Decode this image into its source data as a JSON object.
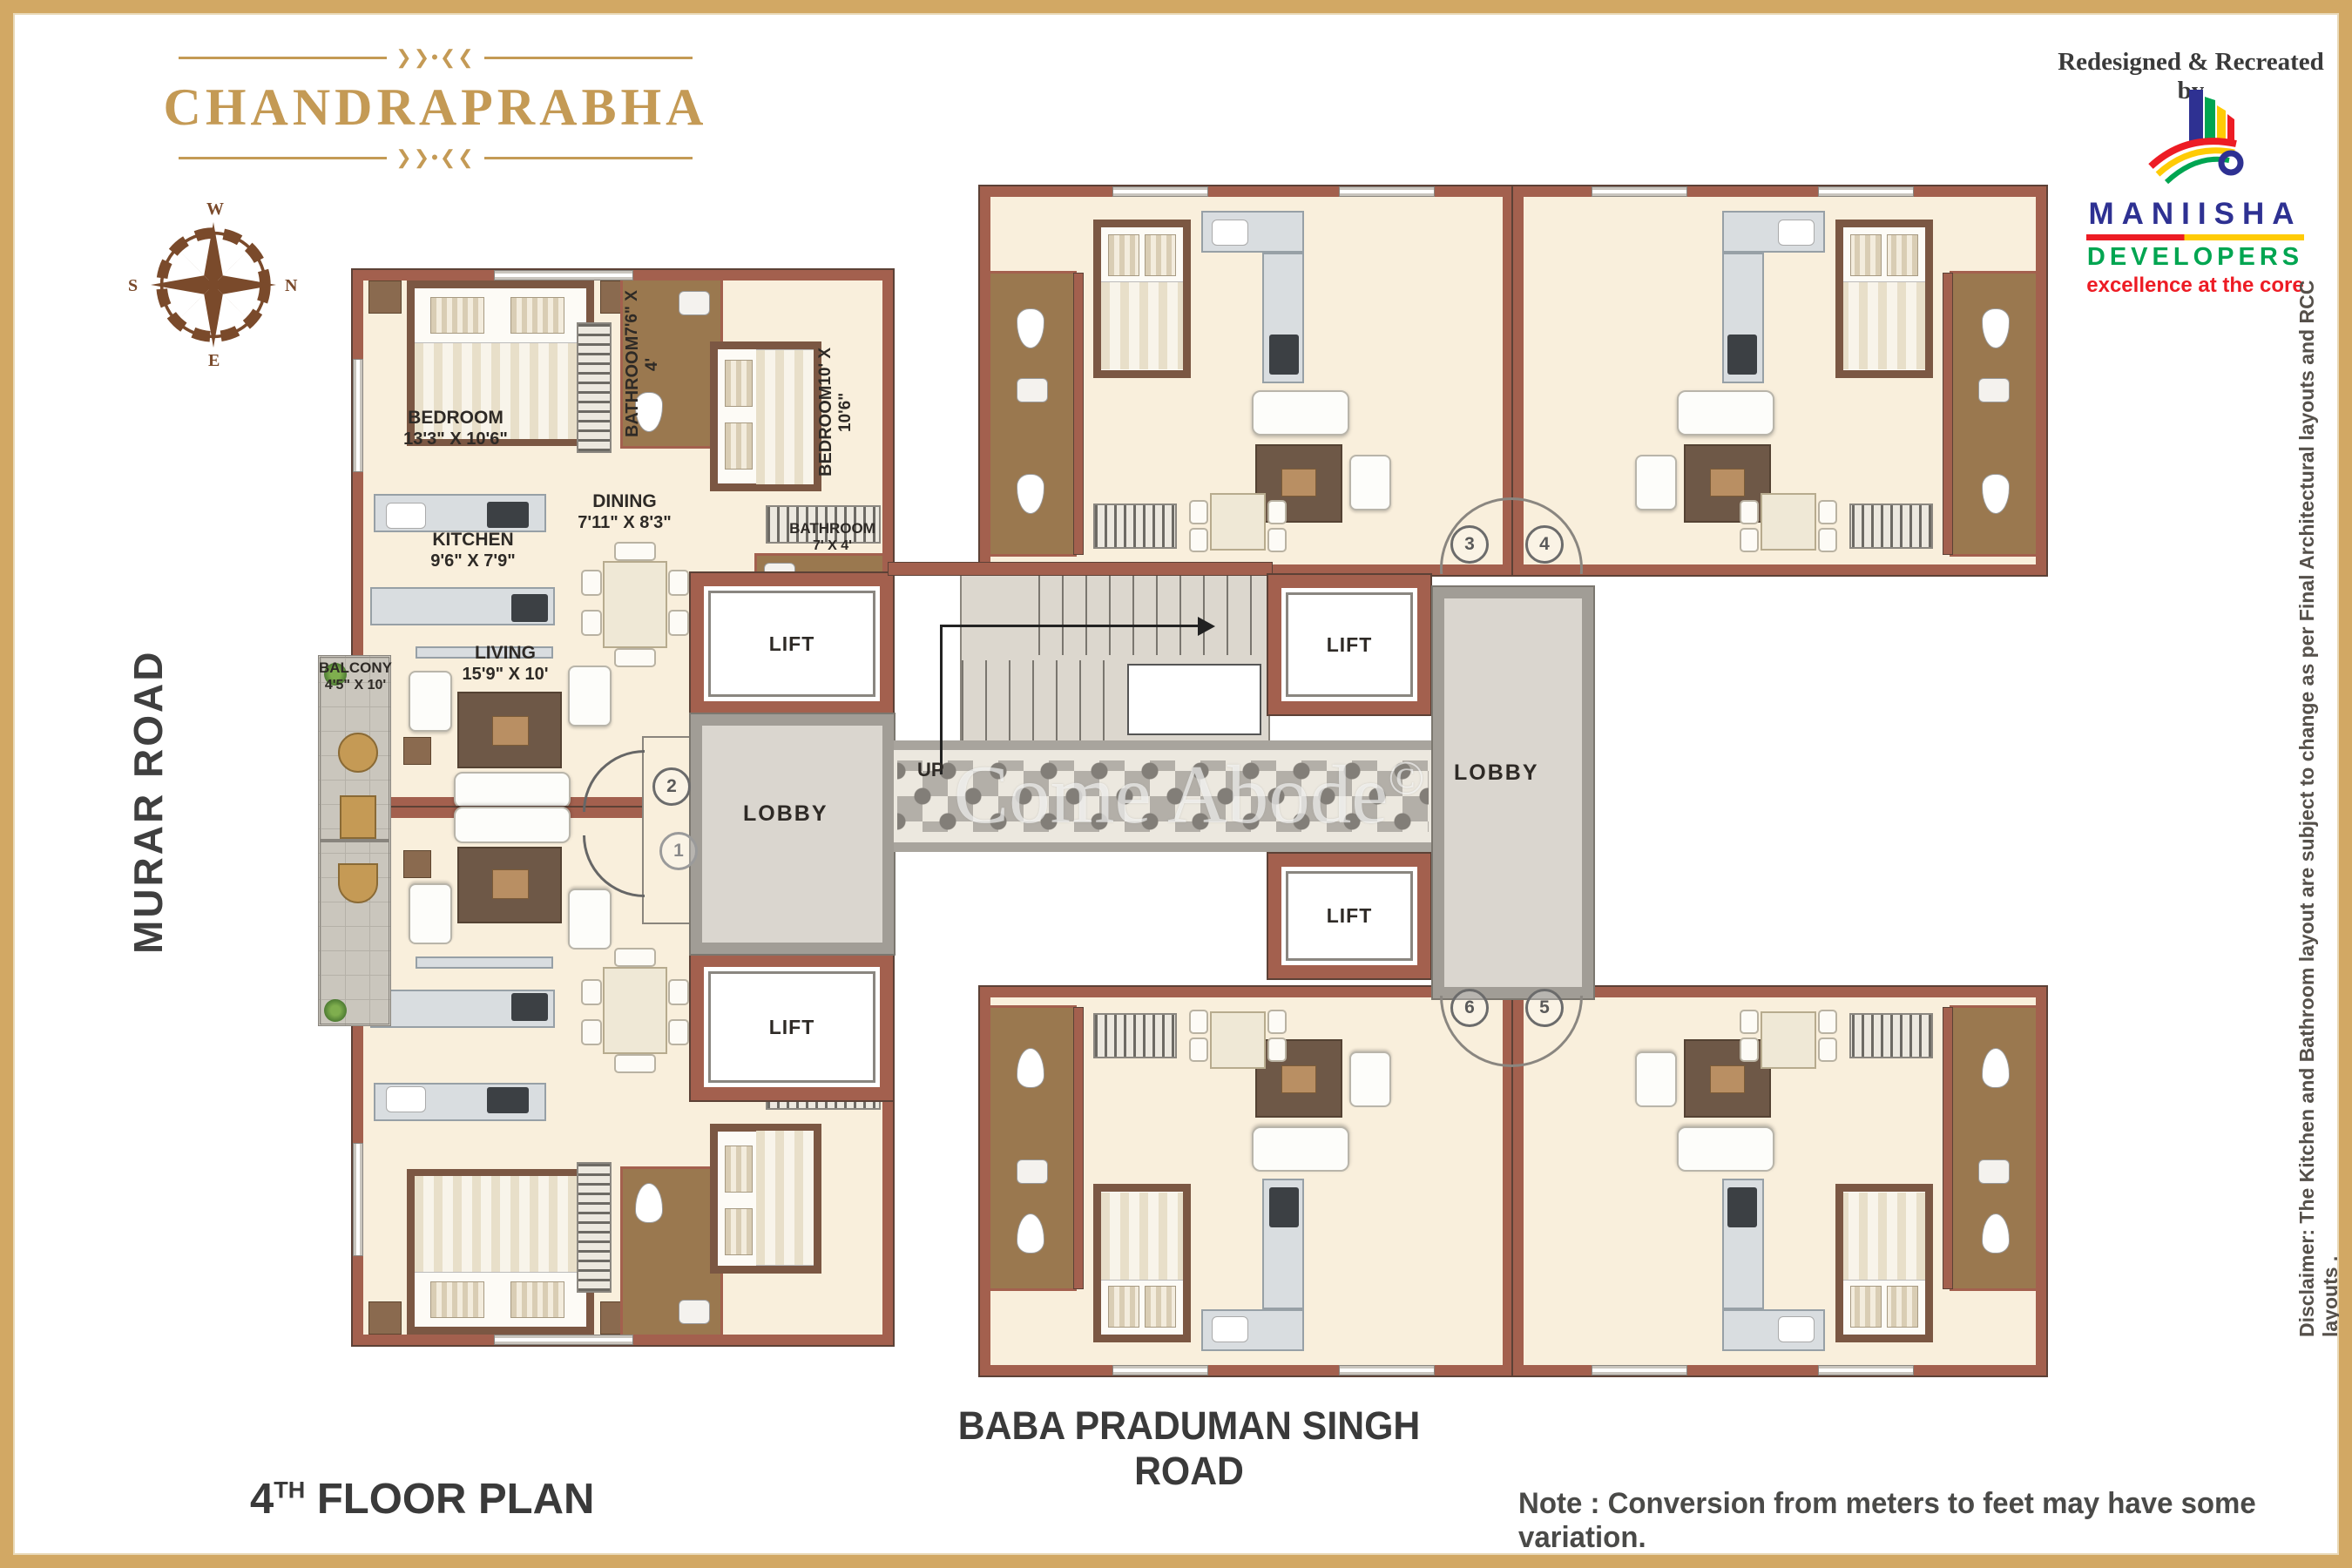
{
  "brand": {
    "title": "CHANDRAPRABHA",
    "ornament_glyph": "❯❯•❮❮",
    "credit": "Redesigned & Recreated by",
    "logo": {
      "name": "MANIISHA",
      "type": "DEVELOPERS",
      "tagline": "excellence at the core"
    }
  },
  "compass": {
    "n": "N",
    "s": "S",
    "e": "E",
    "w": "W"
  },
  "roads": {
    "left": "MURAR ROAD",
    "bottom": "BABA PRADUMAN SINGH ROAD"
  },
  "plan": {
    "rooms": {
      "bedroom1": {
        "name": "BEDROOM",
        "dims": "13'3\" X 10'6\""
      },
      "bathroom1": {
        "name": "BATHROOM",
        "dims": "7'6\" X 4'"
      },
      "bedroom2": {
        "name": "BEDROOM",
        "dims": "10' X 10'6\""
      },
      "dining": {
        "name": "DINING",
        "dims": "7'11\" X 8'3\""
      },
      "kitchen": {
        "name": "KITCHEN",
        "dims": "9'6\" X 7'9\""
      },
      "bathroom2": {
        "name": "BATHROOM",
        "dims": "7' X 4'"
      },
      "balcony": {
        "name": "BALCONY",
        "dims": "4'5\" X 10'"
      },
      "living": {
        "name": "LIVING",
        "dims": "15'9\" X 10'"
      }
    },
    "lift_label": "LIFT",
    "lobby_label": "LOBBY",
    "up_label": "UP",
    "units": {
      "u1": "1",
      "u2": "2",
      "u3": "3",
      "u4": "4",
      "u5": "5",
      "u6": "6"
    }
  },
  "watermark": {
    "text": "Come Abode",
    "mark": "©"
  },
  "footer": {
    "floor_number": "4",
    "floor_ordinal": "TH",
    "floor_text": " FLOOR PLAN",
    "note": "Note : Conversion from meters to feet may have some variation."
  },
  "disclaimer": "Disclaimer: The Kitchen and Bathroom layout are subject to change as per Final Architectural layouts  and RCC layouts ."
}
